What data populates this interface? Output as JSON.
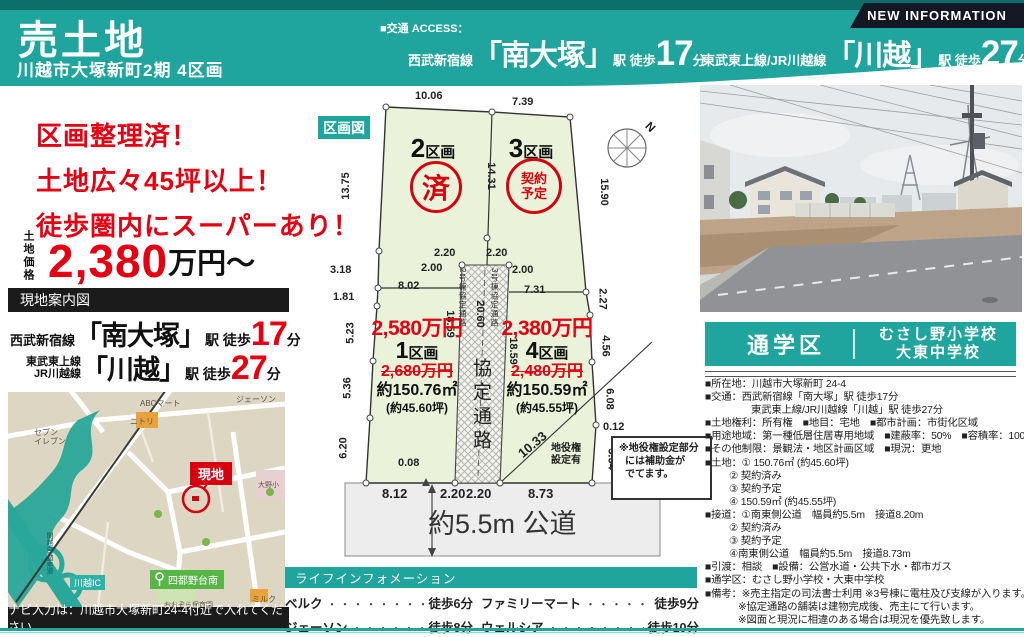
{
  "header": {
    "title": "売土地",
    "subtitle": "川越市大塚新町2期 4区画",
    "new_info": "NEW INFORMATION",
    "access_label": "■交通 ACCESS：",
    "access1": {
      "line": "西武新宿線",
      "station": "「南大塚」",
      "mid": "駅 徒歩",
      "min": "17",
      "unit": "分"
    },
    "access2": {
      "line": "東武東上線/JR川越線",
      "station": "「川越」",
      "mid": "駅 徒歩",
      "min": "27",
      "unit": "分"
    }
  },
  "left": {
    "headline1": "区画整理済！",
    "headline2": "土地広々45坪以上！",
    "headline3": "徒歩圏内にスーパーあり！",
    "price_label": "土地価格",
    "price_value": "2,380",
    "price_unit": "万円～",
    "map_bar": "現地案内図",
    "access1": {
      "line": "西武新宿線",
      "station": "「南大塚」",
      "mid": "駅 徒歩",
      "min": "17",
      "unit": "分"
    },
    "access2": {
      "line_a": "東武東上線",
      "line_b": "JR川越線",
      "station": "「川越」",
      "mid": "駅 徒歩",
      "min": "27",
      "unit": "分"
    },
    "nav_note": "ナビ入力は：川越市大塚新町24-4付近で入れてください。",
    "map_labels": {
      "abc": "ABCマート",
      "nitori": "ニトリ",
      "seven_a": "セブン",
      "seven_b": "イレブン",
      "jason": "ジェーソン",
      "site": "現地",
      "school": "大野小",
      "ic": "川越IC",
      "bus": "四都野台南",
      "nursery": "おおぞら保育園",
      "milk": "ミルク",
      "highway": "関越自動車道"
    }
  },
  "plot": {
    "bar": "区画図",
    "north": "N",
    "p2_num": "2",
    "p2_k": "区画",
    "p2_stamp": "済",
    "p3_num": "3",
    "p3_k": "区画",
    "p3_stamp_a": "契約",
    "p3_stamp_b": "予定",
    "p1": {
      "price": "2,580万円",
      "num": "1",
      "k": "区画",
      "old": "2,680万円",
      "area": "約150.76㎡",
      "tsubo": "(約45.60坪)"
    },
    "p4": {
      "price": "2,380万円",
      "num": "4",
      "k": "区画",
      "old": "2,480万円",
      "area": "約150.59㎡",
      "tsubo": "(約45.55坪)",
      "ease_a": "地役権",
      "ease_b": "設定有"
    },
    "corridor": {
      "l": "2号棟協定通路",
      "r": "3号棟協定通路",
      "c": "協定通路",
      "len": "20.60",
      "sl": "18.59",
      "sr": "18.59"
    },
    "dims": {
      "t1": "10.06",
      "t2": "7.39",
      "l1": "13.75",
      "l2": "3.18",
      "l3": "1.81",
      "l4": "5.23",
      "l5": "5.36",
      "l6": "6.20",
      "r1": "15.90",
      "r2": "2.27",
      "r3": "4.56",
      "r4": "6.08",
      "r5": "0.12",
      "r6": "5.54",
      "mid": "14.31",
      "i1": "8.02",
      "i2": "7.31",
      "o1": "2.00",
      "o2": "2.00",
      "c1": "2.20",
      "c2": "2.20",
      "b0": "0.08",
      "b1": "8.12",
      "b2": "2.20",
      "b3": "2.20",
      "b4": "8.73",
      "diag": "10.33"
    },
    "note1": "※地役権設定部分",
    "note2": "には補助金が",
    "note3": "でてます。",
    "road": "約5.5m 公道"
  },
  "life": {
    "bar": "ライフインフォメーション",
    "s1": {
      "name": "ベルク",
      "dots": "・・・・・・・・・・・",
      "time": "徒歩6分"
    },
    "s2": {
      "name": "ファミリーマート",
      "dots": "・・・・・・",
      "time": "徒歩9分"
    },
    "s3": {
      "name": "ジェーソン",
      "dots": "・・・・・・・・・",
      "time": "徒歩8分"
    },
    "s4": {
      "name": "ウェルシア",
      "dots": "・・・・・・・・",
      "time": "徒歩10分"
    }
  },
  "school": {
    "label": "通学区",
    "l1": "むさし野小学校",
    "l2": "大東中学校"
  },
  "details": {
    "lines": [
      "■所在地：川越市大塚新町 24-4",
      "■交通：西武新宿線「南大塚」駅 徒歩17分",
      "東武東上線/JR川越線「川越」駅 徒歩27分",
      "■土地権利：所有権　■地目：宅地　■都市計画：市街化区域",
      "■用途地域：第一種低層住居専用地域　■建蔽率：50%　■容積率：100%",
      "■その他制限：景観法・地区計画区域　■現況：更地",
      "■土地：① 150.76㎡ (約45.60坪)",
      "② 契約済み",
      "③ 契約予定",
      "④ 150.59㎡ (約45.55坪)",
      "■接道：①南東側公道　幅員約5.5m　接道8.20m",
      "② 契約済み",
      "③ 契約予定",
      "④南東側公道　幅員約5.5m　接道8.73m",
      "■引渡：相談　■設備：公営水道・公共下水・都市ガス",
      "■通学区：むさし野小学校・大東中学校",
      "■備考：※売主指定の司法書士利用 ※3号棟に電柱及び支線が入ります。",
      "※協定通路の舗装は建物完成後、売主にて行います。",
      "※図面と現況に相違のある場合は現況を優先致します。"
    ]
  }
}
